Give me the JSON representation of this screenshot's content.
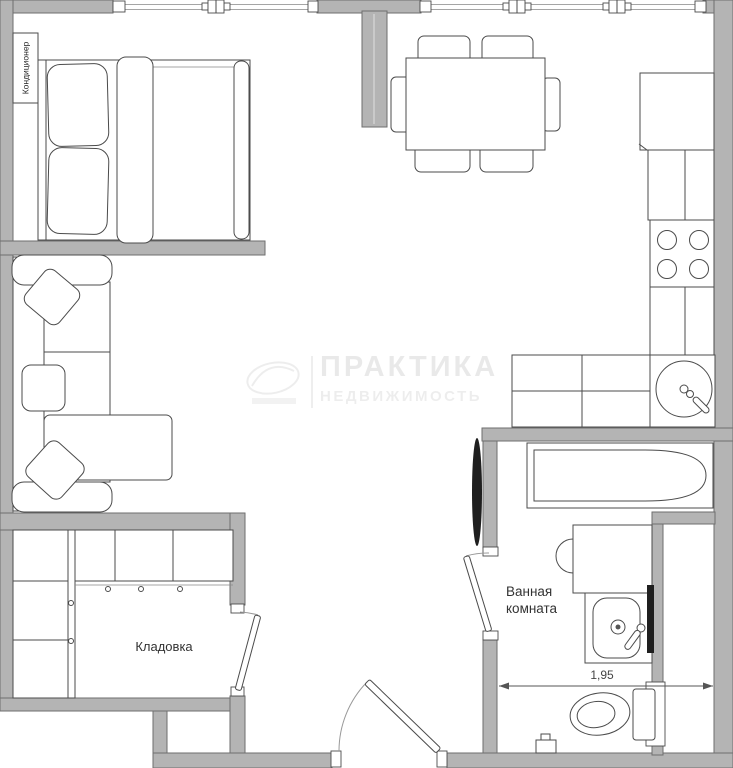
{
  "plan": {
    "labels": {
      "air_conditioner": "Кондиционер",
      "storage_room": "Кладовка",
      "bathroom_line1": "Ванная",
      "bathroom_line2": "комната",
      "bath_width_dimension": "1,95"
    },
    "watermark": {
      "line1": "ПРАКТИКА",
      "line2": "НЕДВИЖИМОСТЬ"
    },
    "colors": {
      "wall-fill": "#b4b4b4",
      "wall-edge": "#6e6e6e",
      "line": "#4b4b4b",
      "thin": "#888888",
      "dark": "#1f1f1f",
      "dim": "#555555",
      "label": "#333333",
      "background": "#ffffff"
    }
  }
}
